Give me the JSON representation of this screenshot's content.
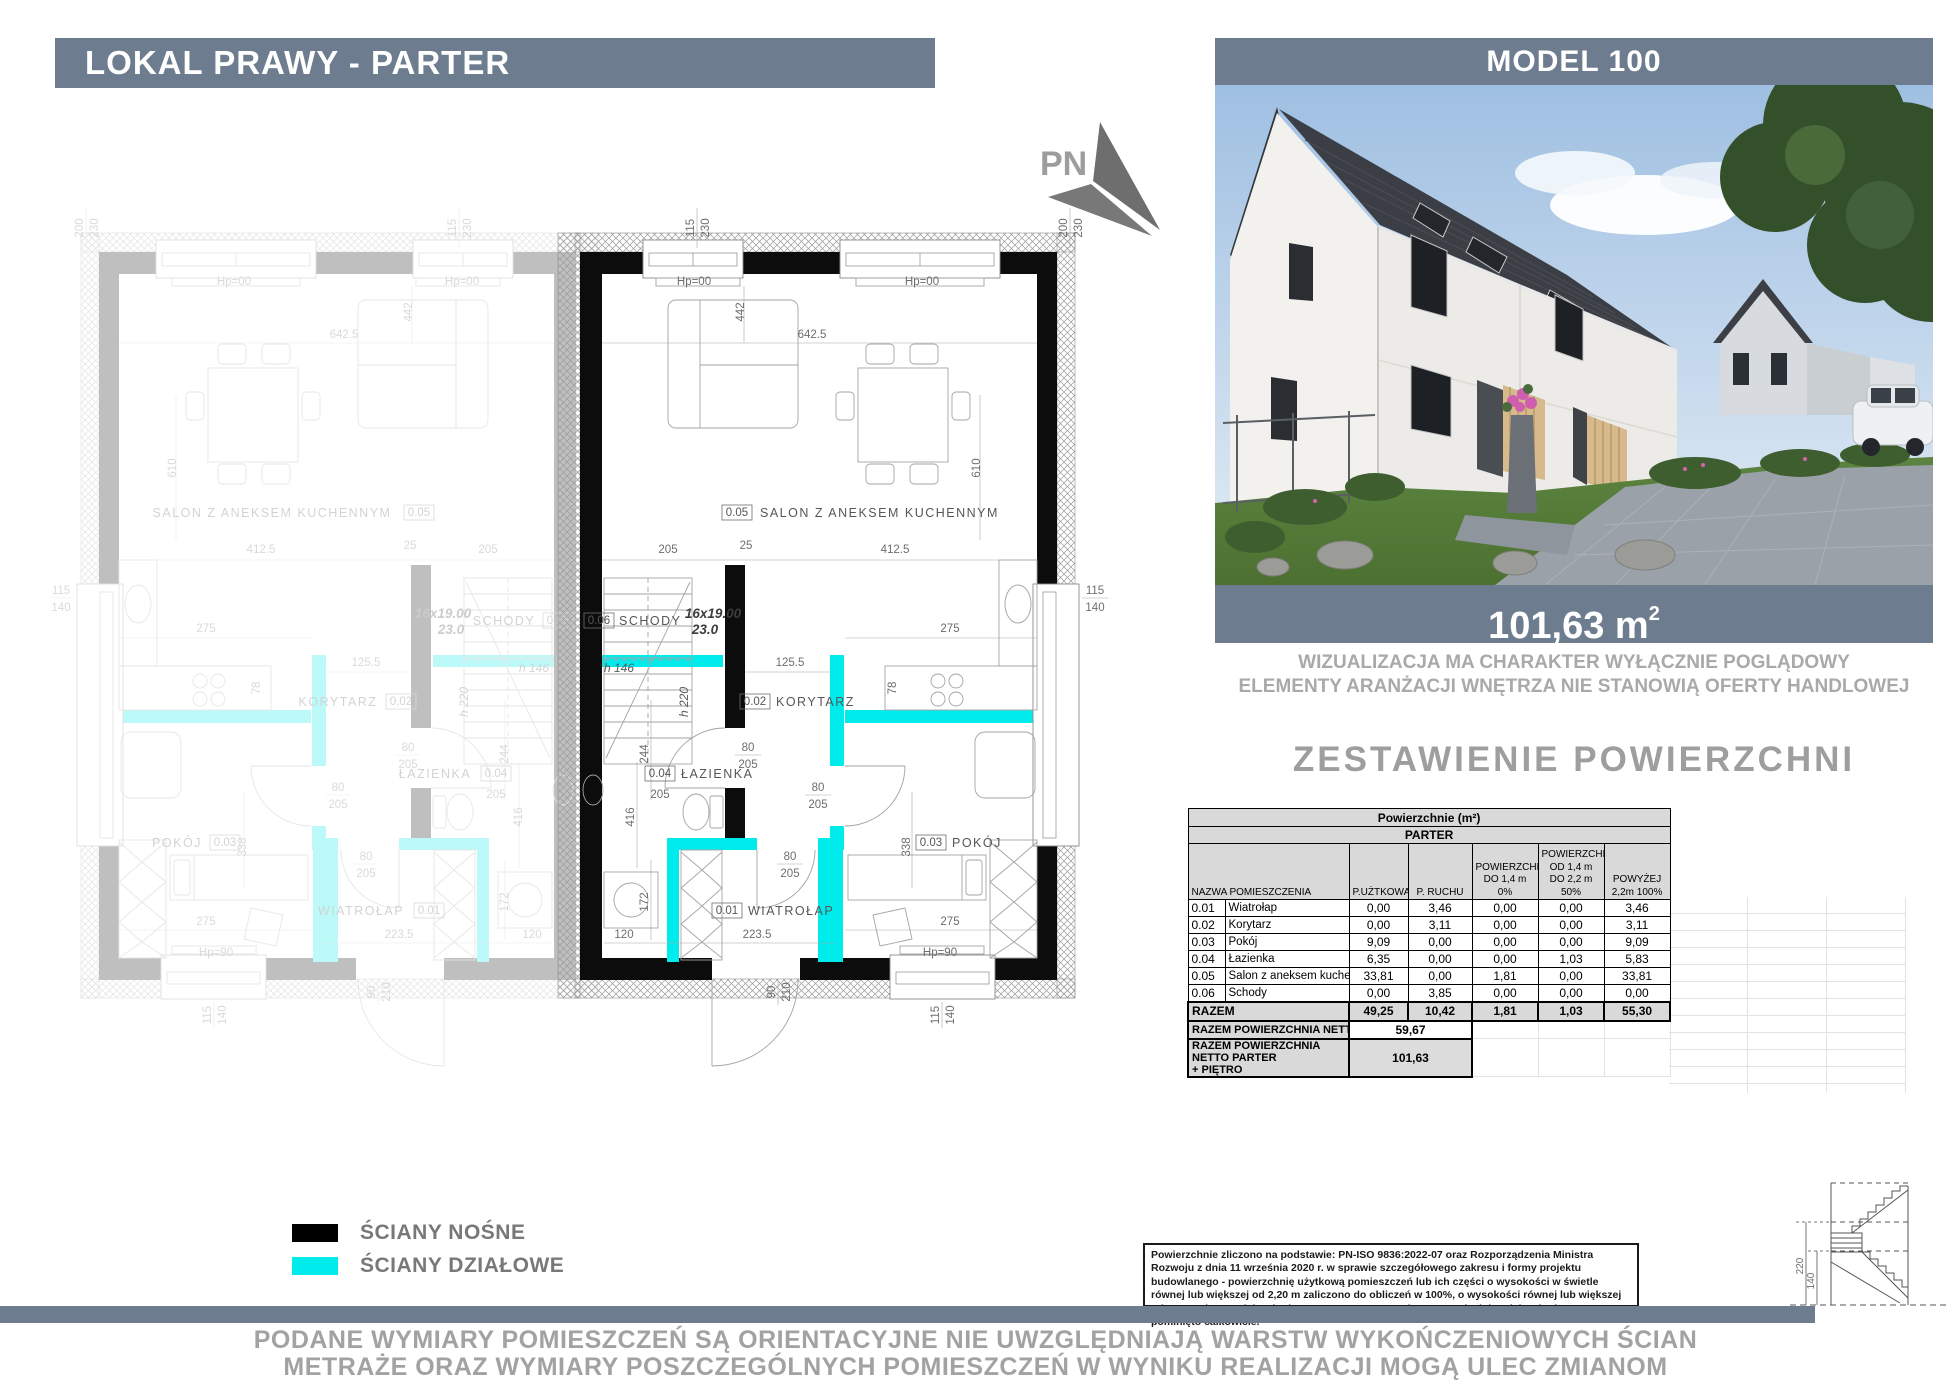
{
  "page": {
    "header_left": "LOKAL PRAWY - PARTER",
    "header_right": "MODEL 100"
  },
  "north_arrow": {
    "label": "PN"
  },
  "visualization": {
    "area_value": "101,63 m",
    "area_sup": "2",
    "disclaimer_line1": "WIZUALIZACJA MA CHARAKTER WYŁĄCZNIE POGLĄDOWY",
    "disclaimer_line2": "ELEMENTY ARANŻACJI WNĘTRZA NIE STANOWIĄ OFERTY HANDLOWEJ"
  },
  "area_table": {
    "title": "ZESTAWIENIE POWIERZCHNI",
    "surface_header": "Powierzchnie (m²)",
    "floor_header": "PARTER",
    "col_name": "NAZWA POMIESZCZENIA",
    "col_uzytkowa": "P.UŻTKOWA",
    "col_ruchu": "P. RUCHU",
    "col_do14": "POWIERZCHNIA DO 1,4 m 0%",
    "col_od14do22": "POWIERZCHNIA OD 1,4 m DO 2,2 m 50%",
    "col_powyzej22": "POWYŻEJ 2,2m 100%",
    "rows": [
      {
        "no": "0.01",
        "name": "Wiatrołap",
        "u": "0,00",
        "r": "3,46",
        "a": "0,00",
        "b": "0,00",
        "c": "3,46"
      },
      {
        "no": "0.02",
        "name": "Korytarz",
        "u": "0,00",
        "r": "3,11",
        "a": "0,00",
        "b": "0,00",
        "c": "3,11"
      },
      {
        "no": "0.03",
        "name": "Pokój",
        "u": "9,09",
        "r": "0,00",
        "a": "0,00",
        "b": "0,00",
        "c": "9,09"
      },
      {
        "no": "0.04",
        "name": "Łazienka",
        "u": "6,35",
        "r": "0,00",
        "a": "0,00",
        "b": "1,03",
        "c": "5,83"
      },
      {
        "no": "0.05",
        "name": "Salon z aneksem kuchennym",
        "u": "33,81",
        "r": "0,00",
        "a": "1,81",
        "b": "0,00",
        "c": "33,81"
      },
      {
        "no": "0.06",
        "name": "Schody",
        "u": "0,00",
        "r": "3,85",
        "a": "0,00",
        "b": "0,00",
        "c": "0,00"
      }
    ],
    "razem": {
      "label": "RAZEM",
      "u": "49,25",
      "r": "10,42",
      "a": "1,81",
      "b": "1,03",
      "c": "55,30"
    },
    "netto_parter": {
      "label": "RAZEM POWIERZCHNIA NETTO PARTER",
      "value": "59,67"
    },
    "netto_total": {
      "label_line1": "RAZEM POWIERZCHNIA NETTO PARTER",
      "label_line2": "+ PIĘTRO",
      "value": "101,63"
    }
  },
  "legend": {
    "nosne": "ŚCIANY NOŚNE",
    "dzialowe": "ŚCIANY DZIAŁOWE",
    "nosne_color": "#000000",
    "dzialowe_color": "#00ecec"
  },
  "legal_note": "Powierzchnie zliczono na podstawie: PN-ISO 9836:2022-07 oraz Rozporządzenia Ministra Rozwoju z dnia 11 września 2020 r. w sprawie szczegółowego zakresu i formy projektu budowlanego -  powierzchnię użytkową  pomieszczeń lub ich części o wysokości w świetle równej lub większej od 2,20 m zaliczono  do obliczeń w 100%, o wysokości równej lub większej od 1,40 m, lecz mniejszej od 2,20 m – w 50%, natomiast o wysokości mniejszej od 1,40 m pominięto całkowicie.",
  "footer": {
    "line1": "PODANE WYMIARY POMIESZCZEŃ SĄ ORIENTACYJNE NIE UWZGLĘDNIAJĄ WARSTW WYKOŃCZENIOWYCH ŚCIAN",
    "line2": "METRAŻE ORAZ WYMIARY POSZCZEGÓLNYCH POMIESZCZEŃ W WYNIKU REALIZACJI MOGĄ ULEC ZMIANOM"
  },
  "plan": {
    "rooms": [
      {
        "no": "0.01",
        "name": "WIATROŁAP"
      },
      {
        "no": "0.02",
        "name": "KORYTARZ"
      },
      {
        "no": "0.03",
        "name": "POKÓJ"
      },
      {
        "no": "0.04",
        "name": "ŁAZIENKA"
      },
      {
        "no": "0.05",
        "name": "SALON Z ANEKSEM KUCHENNYM"
      },
      {
        "no": "0.06",
        "name": "SCHODY"
      }
    ],
    "stair_note1": "16x19.00",
    "stair_note2": "23.0",
    "heights": {
      "h146": "h 146",
      "h220": "h 220"
    },
    "levels": {
      "hp00": "Hp=00",
      "hp90": "Hp=90"
    },
    "dims": {
      "d115": "115",
      "d230": "230",
      "d200": "200",
      "d140": "140",
      "d642": "642.5",
      "d442": "442",
      "d610": "610",
      "d205": "205",
      "d25": "25",
      "d412": "412.5",
      "d125": "125.5",
      "d78": "78",
      "d275": "275",
      "d80": "80",
      "d244": "244",
      "d416": "416",
      "d172": "172",
      "d120": "120",
      "d223": "223.5",
      "d90": "90",
      "d210": "210",
      "d338": "338"
    },
    "detail": {
      "d220": "220",
      "d140": "140"
    }
  }
}
